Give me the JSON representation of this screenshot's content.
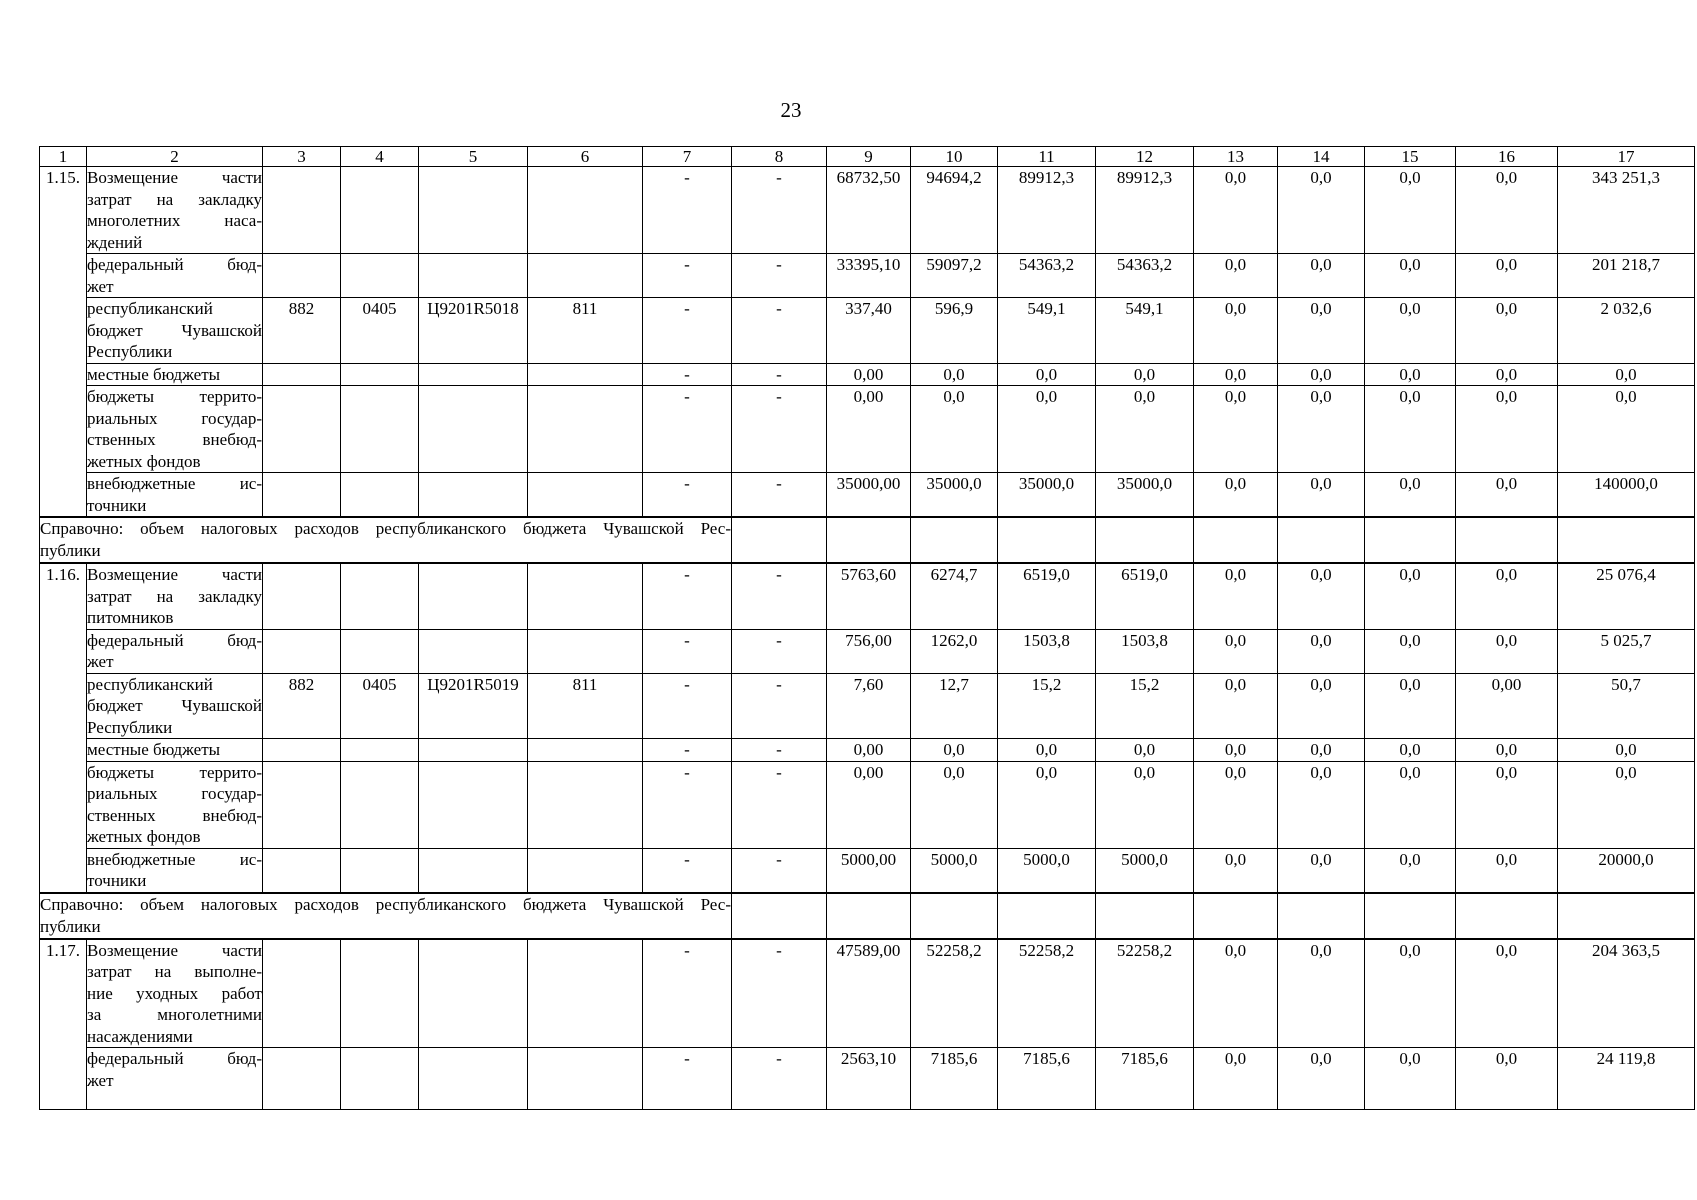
{
  "page": {
    "number": "23"
  },
  "table": {
    "col_widths": [
      47,
      176,
      78,
      78,
      109,
      115,
      89,
      95,
      84,
      87,
      98,
      98,
      84,
      87,
      91,
      102,
      137
    ],
    "header": [
      "1",
      "2",
      "3",
      "4",
      "5",
      "6",
      "7",
      "8",
      "9",
      "10",
      "11",
      "12",
      "13",
      "14",
      "15",
      "16",
      "17"
    ],
    "rows": [
      {
        "kind": "group",
        "num": "1.15.",
        "span": 6,
        "label_lines": [
          "Возмещение части",
          "затрат на закладку",
          "многолетних наса-",
          "ждений"
        ],
        "codes": [
          "",
          "",
          "",
          ""
        ],
        "values": [
          "-",
          "-",
          "68732,50",
          "94694,2",
          "89912,3",
          "89912,3",
          "0,0",
          "0,0",
          "0,0",
          "0,0",
          "343 251,3"
        ]
      },
      {
        "kind": "sub",
        "label_lines": [
          "федеральный бюд-",
          "жет"
        ],
        "codes": [
          "",
          "",
          "",
          ""
        ],
        "values": [
          "-",
          "-",
          "33395,10",
          "59097,2",
          "54363,2",
          "54363,2",
          "0,0",
          "0,0",
          "0,0",
          "0,0",
          "201 218,7"
        ]
      },
      {
        "kind": "sub",
        "label_lines": [
          "республиканский",
          "бюджет Чувашской",
          "Республики"
        ],
        "codes": [
          "882",
          "0405",
          "Ц9201R5018",
          "811"
        ],
        "values": [
          "-",
          "-",
          "337,40",
          "596,9",
          "549,1",
          "549,1",
          "0,0",
          "0,0",
          "0,0",
          "0,0",
          "2 032,6"
        ]
      },
      {
        "kind": "sub",
        "label_lines": [
          "местные бюджеты"
        ],
        "codes": [
          "",
          "",
          "",
          ""
        ],
        "values": [
          "-",
          "-",
          "0,00",
          "0,0",
          "0,0",
          "0,0",
          "0,0",
          "0,0",
          "0,0",
          "0,0",
          "0,0"
        ]
      },
      {
        "kind": "sub",
        "label_lines": [
          "бюджеты террито-",
          "риальных государ-",
          "ственных внебюд-",
          "жетных фондов"
        ],
        "codes": [
          "",
          "",
          "",
          ""
        ],
        "values": [
          "-",
          "-",
          "0,00",
          "0,0",
          "0,0",
          "0,0",
          "0,0",
          "0,0",
          "0,0",
          "0,0",
          "0,0"
        ]
      },
      {
        "kind": "sub",
        "label_lines": [
          "внебюджетные ис-",
          "точники"
        ],
        "codes": [
          "",
          "",
          "",
          ""
        ],
        "values": [
          "-",
          "-",
          "35000,00",
          "35000,0",
          "35000,0",
          "35000,0",
          "0,0",
          "0,0",
          "0,0",
          "0,0",
          "140000,0"
        ]
      },
      {
        "kind": "note",
        "lines": [
          "Справочно: объем налоговых расходов республиканского бюджета Чувашской Рес-",
          "публики"
        ]
      },
      {
        "kind": "group",
        "num": "1.16.",
        "span": 6,
        "label_lines": [
          "Возмещение части",
          "затрат на закладку",
          "питомников"
        ],
        "codes": [
          "",
          "",
          "",
          ""
        ],
        "values": [
          "-",
          "-",
          "5763,60",
          "6274,7",
          "6519,0",
          "6519,0",
          "0,0",
          "0,0",
          "0,0",
          "0,0",
          "25 076,4"
        ]
      },
      {
        "kind": "sub",
        "label_lines": [
          "федеральный бюд-",
          "жет"
        ],
        "codes": [
          "",
          "",
          "",
          ""
        ],
        "values": [
          "-",
          "-",
          "756,00",
          "1262,0",
          "1503,8",
          "1503,8",
          "0,0",
          "0,0",
          "0,0",
          "0,0",
          "5 025,7"
        ]
      },
      {
        "kind": "sub",
        "label_lines": [
          "республиканский",
          "бюджет Чувашской",
          "Республики"
        ],
        "codes": [
          "882",
          "0405",
          "Ц9201R5019",
          "811"
        ],
        "values": [
          "-",
          "-",
          "7,60",
          "12,7",
          "15,2",
          "15,2",
          "0,0",
          "0,0",
          "0,0",
          "0,00",
          "50,7"
        ]
      },
      {
        "kind": "sub",
        "label_lines": [
          "местные бюджеты"
        ],
        "codes": [
          "",
          "",
          "",
          ""
        ],
        "values": [
          "-",
          "-",
          "0,00",
          "0,0",
          "0,0",
          "0,0",
          "0,0",
          "0,0",
          "0,0",
          "0,0",
          "0,0"
        ]
      },
      {
        "kind": "sub",
        "label_lines": [
          "бюджеты террито-",
          "риальных государ-",
          "ственных внебюд-",
          "жетных фондов"
        ],
        "codes": [
          "",
          "",
          "",
          ""
        ],
        "values": [
          "-",
          "-",
          "0,00",
          "0,0",
          "0,0",
          "0,0",
          "0,0",
          "0,0",
          "0,0",
          "0,0",
          "0,0"
        ]
      },
      {
        "kind": "sub",
        "label_lines": [
          "внебюджетные ис-",
          "точники"
        ],
        "codes": [
          "",
          "",
          "",
          ""
        ],
        "values": [
          "-",
          "-",
          "5000,00",
          "5000,0",
          "5000,0",
          "5000,0",
          "0,0",
          "0,0",
          "0,0",
          "0,0",
          "20000,0"
        ]
      },
      {
        "kind": "note",
        "lines": [
          "Справочно: объем налоговых расходов республиканского бюджета Чувашской Рес-",
          "публики"
        ]
      },
      {
        "kind": "group",
        "num": "1.17.",
        "span": 2,
        "label_lines": [
          "Возмещение части",
          "затрат на выполне-",
          "ние уходных работ",
          "за многолетними",
          "насаждениями"
        ],
        "codes": [
          "",
          "",
          "",
          ""
        ],
        "values": [
          "-",
          "-",
          "47589,00",
          "52258,2",
          "52258,2",
          "52258,2",
          "0,0",
          "0,0",
          "0,0",
          "0,0",
          "204 363,5"
        ]
      },
      {
        "kind": "sub",
        "min_h": 62,
        "label_lines": [
          "федеральный бюд-",
          "жет"
        ],
        "codes": [
          "",
          "",
          "",
          ""
        ],
        "values": [
          "-",
          "-",
          "2563,10",
          "7185,6",
          "7185,6",
          "7185,6",
          "0,0",
          "0,0",
          "0,0",
          "0,0",
          "24 119,8"
        ]
      }
    ]
  }
}
